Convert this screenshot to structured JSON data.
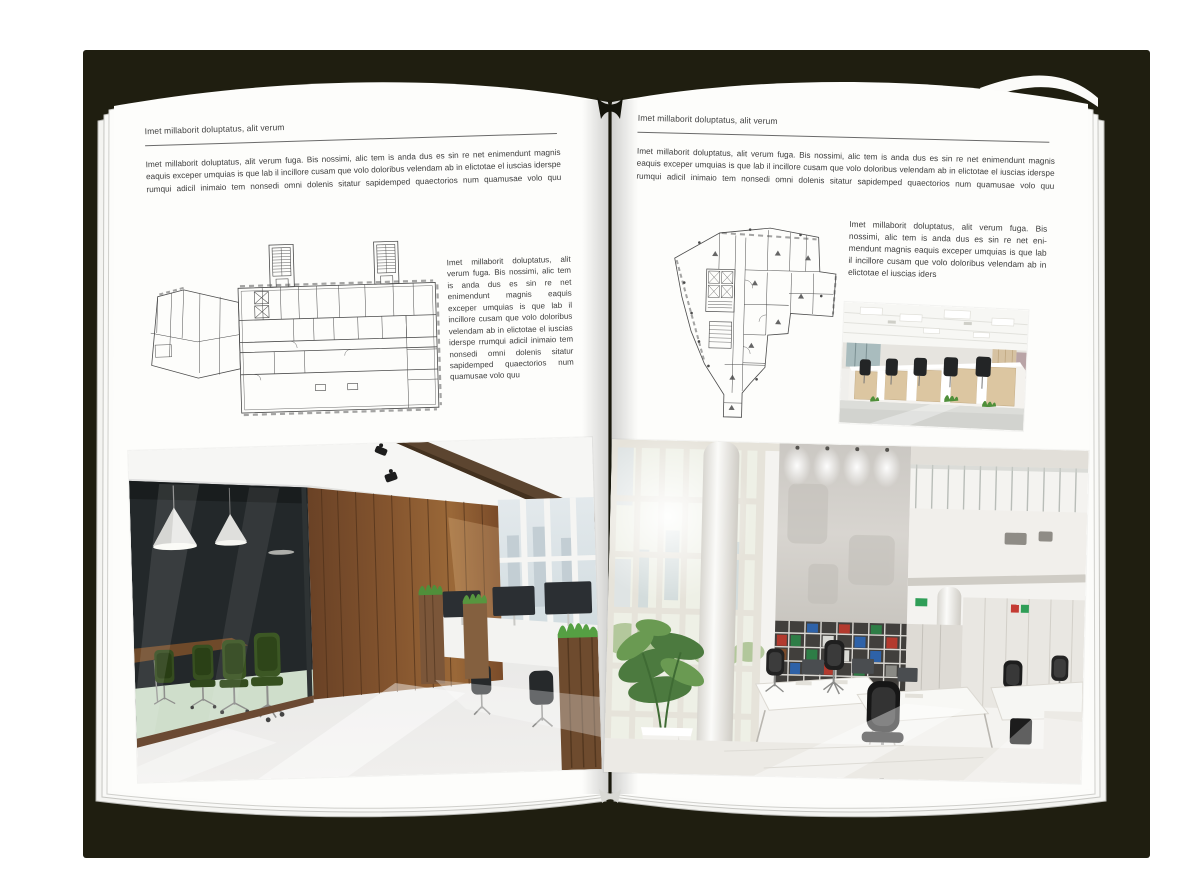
{
  "document": {
    "kind": "open-magazine-spread-mockup"
  },
  "colors": {
    "backdrop": "#ffffff",
    "book_shadow": "#1f1e10",
    "page": "#fdfdfb",
    "text": "#3d3d3d",
    "rule": "#6a6a6a"
  },
  "left_page": {
    "header": "Imet millaborit doluptatus, alit verum",
    "intro": "Imet millaborit doluptatus, alit verum fuga. Bis nossimi, alic tem is anda dus es sin re net enimendunt magnis eaquis exceper umquias is que lab il incillore cusam que volo doloribus velendam ab in elictotae el iuscias iderspe rumqui adicil inimaio tem nonsedi omni dolenis sitatur sapidemped quaectorios num quamusae volo quu",
    "column": "Imet millaborit doluptatus, alit verum fuga. Bis nossimi, alic tem is anda dus es sin re net enimendunt magnis eaquis exceper umquias is que lab il incillore cusam que volo doloribus velendam ab in elictotae el iuscias iderspe rrumqui adicil inimaio tem nonsedi omni dolenis sitatur sapidemped quaectorios num quamusae volo quu"
  },
  "right_page": {
    "header": "Imet millaborit doluptatus, alit verum",
    "intro": "Imet millaborit doluptatus, alit verum fuga. Bis nossimi, alic tem is anda dus es sin re net enimendunt magnis eaquis exceper umquias is que lab il incillore cusam que volo doloribus velendam ab in elictotae el iuscias iderspe rumqui adicil inimaio tem nonsedi omni dolenis sitatur sapidemped quaectorios num quamusae volo quu",
    "column": "Imet millaborit doluptatus, alit verum fuga. Bis nossimi, alic tem is anda dus es sin re net eni-mendunt magnis eaquis exceper umquias is que lab il incillore cusam que volo doloribus velendam ab in elictotae el iuscias iders"
  }
}
